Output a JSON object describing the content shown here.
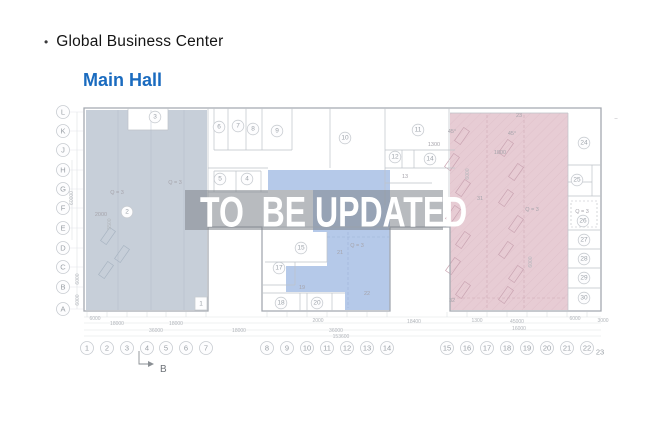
{
  "header": {
    "bullet": "•",
    "title": "Global Business Center",
    "subtitle": "Main Hall"
  },
  "overlay": {
    "text": "TO  BE UPDATED"
  },
  "plan": {
    "colors": {
      "left_zone": "#c7cfd9",
      "center_zone": "#b5c9e9",
      "right_zone": "#e7ccd4",
      "overlay_band": "rgba(125,131,139,0.55)",
      "accent_blue": "#1a6bbf"
    },
    "section_marker": "B",
    "row_labels": [
      {
        "t": "L",
        "y": 112
      },
      {
        "t": "K",
        "y": 131
      },
      {
        "t": "J",
        "y": 150
      },
      {
        "t": "H",
        "y": 170
      },
      {
        "t": "G",
        "y": 189
      },
      {
        "t": "F",
        "y": 208
      },
      {
        "t": "E",
        "y": 228
      },
      {
        "t": "D",
        "y": 248
      },
      {
        "t": "C",
        "y": 267
      },
      {
        "t": "B",
        "y": 287
      },
      {
        "t": "A",
        "y": 309
      }
    ],
    "col_labels": [
      {
        "t": "1",
        "x": 87
      },
      {
        "t": "2",
        "x": 107
      },
      {
        "t": "3",
        "x": 127
      },
      {
        "t": "4",
        "x": 147
      },
      {
        "t": "5",
        "x": 166
      },
      {
        "t": "6",
        "x": 186
      },
      {
        "t": "7",
        "x": 206
      },
      {
        "t": "8",
        "x": 267
      },
      {
        "t": "9",
        "x": 287
      },
      {
        "t": "10",
        "x": 307
      },
      {
        "t": "11",
        "x": 327
      },
      {
        "t": "12",
        "x": 347
      },
      {
        "t": "13",
        "x": 367
      },
      {
        "t": "14",
        "x": 387
      },
      {
        "t": "15",
        "x": 447
      },
      {
        "t": "16",
        "x": 467
      },
      {
        "t": "17",
        "x": 487
      },
      {
        "t": "18",
        "x": 507
      },
      {
        "t": "19",
        "x": 527
      },
      {
        "t": "20",
        "x": 547
      },
      {
        "t": "21",
        "x": 567
      },
      {
        "t": "22",
        "x": 587
      }
    ],
    "col_end": {
      "t": "23",
      "x": 600,
      "y": 352
    },
    "rooms": [
      {
        "t": "1",
        "x": 201,
        "y": 304,
        "box": true
      },
      {
        "t": "2",
        "x": 127,
        "y": 212
      },
      {
        "t": "3",
        "x": 155,
        "y": 117
      },
      {
        "t": "4",
        "x": 247,
        "y": 179
      },
      {
        "t": "5",
        "x": 220,
        "y": 179
      },
      {
        "t": "6",
        "x": 219,
        "y": 127
      },
      {
        "t": "7",
        "x": 238,
        "y": 126
      },
      {
        "t": "8",
        "x": 253,
        "y": 129
      },
      {
        "t": "9",
        "x": 277,
        "y": 131
      },
      {
        "t": "10",
        "x": 345,
        "y": 138
      },
      {
        "t": "11",
        "x": 418,
        "y": 130
      },
      {
        "t": "12",
        "x": 395,
        "y": 157
      },
      {
        "t": "14",
        "x": 430,
        "y": 159
      },
      {
        "t": "15",
        "x": 301,
        "y": 248
      },
      {
        "t": "17",
        "x": 279,
        "y": 268
      },
      {
        "t": "18",
        "x": 281,
        "y": 303
      },
      {
        "t": "20",
        "x": 317,
        "y": 303
      },
      {
        "t": "24",
        "x": 584,
        "y": 143
      },
      {
        "t": "25",
        "x": 577,
        "y": 180
      },
      {
        "t": "26",
        "x": 583,
        "y": 221
      },
      {
        "t": "27",
        "x": 584,
        "y": 240
      },
      {
        "t": "28",
        "x": 584,
        "y": 259
      },
      {
        "t": "29",
        "x": 584,
        "y": 278
      },
      {
        "t": "30",
        "x": 584,
        "y": 298
      }
    ],
    "texts": [
      {
        "t": "13",
        "x": 405,
        "y": 177
      },
      {
        "t": "19",
        "x": 302,
        "y": 288
      },
      {
        "t": "21",
        "x": 340,
        "y": 253
      },
      {
        "t": "22",
        "x": 367,
        "y": 294
      },
      {
        "t": "31",
        "x": 480,
        "y": 199
      },
      {
        "t": "32",
        "x": 452,
        "y": 301
      },
      {
        "t": "23",
        "x": 519,
        "y": 116
      },
      {
        "t": "Q = 3",
        "x": 175,
        "y": 183
      },
      {
        "t": "Q = 3",
        "x": 117,
        "y": 193
      },
      {
        "t": "2000",
        "x": 101,
        "y": 215
      },
      {
        "t": "Q = 3",
        "x": 357,
        "y": 246
      },
      {
        "t": "Q = 3",
        "x": 532,
        "y": 210
      },
      {
        "t": "Q = 3",
        "x": 582,
        "y": 212
      },
      {
        "t": "1800",
        "x": 500,
        "y": 153
      },
      {
        "t": "1300",
        "x": 434,
        "y": 145
      },
      {
        "t": "45°",
        "x": 452,
        "y": 132
      },
      {
        "t": "45°",
        "x": 512,
        "y": 134
      },
      {
        "t": "–",
        "x": 616,
        "y": 119
      }
    ],
    "dims": [
      {
        "t": "6000",
        "x": 95,
        "y": 319
      },
      {
        "t": "18000",
        "x": 117,
        "y": 324
      },
      {
        "t": "18000",
        "x": 176,
        "y": 324
      },
      {
        "t": "36000",
        "x": 156,
        "y": 331
      },
      {
        "t": "18000",
        "x": 239,
        "y": 331
      },
      {
        "t": "2000",
        "x": 318,
        "y": 321
      },
      {
        "t": "36000",
        "x": 336,
        "y": 331
      },
      {
        "t": "153600",
        "x": 341,
        "y": 337
      },
      {
        "t": "18400",
        "x": 414,
        "y": 322
      },
      {
        "t": "1300",
        "x": 477,
        "y": 321
      },
      {
        "t": "45000",
        "x": 517,
        "y": 322
      },
      {
        "t": "16000",
        "x": 519,
        "y": 329
      },
      {
        "t": "6000",
        "x": 575,
        "y": 319
      },
      {
        "t": "3000",
        "x": 603,
        "y": 321
      },
      {
        "t": "60000",
        "x": 72,
        "y": 198,
        "rot": -90
      },
      {
        "t": "6000",
        "x": 78,
        "y": 279,
        "rot": -90
      },
      {
        "t": "6000",
        "x": 78,
        "y": 300,
        "rot": -90
      },
      {
        "t": "6000",
        "x": 468,
        "y": 174,
        "rot": -90
      },
      {
        "t": "6000",
        "x": 531,
        "y": 262,
        "rot": -90
      },
      {
        "t": "5500",
        "x": 110,
        "y": 224,
        "rot": -90
      }
    ]
  }
}
